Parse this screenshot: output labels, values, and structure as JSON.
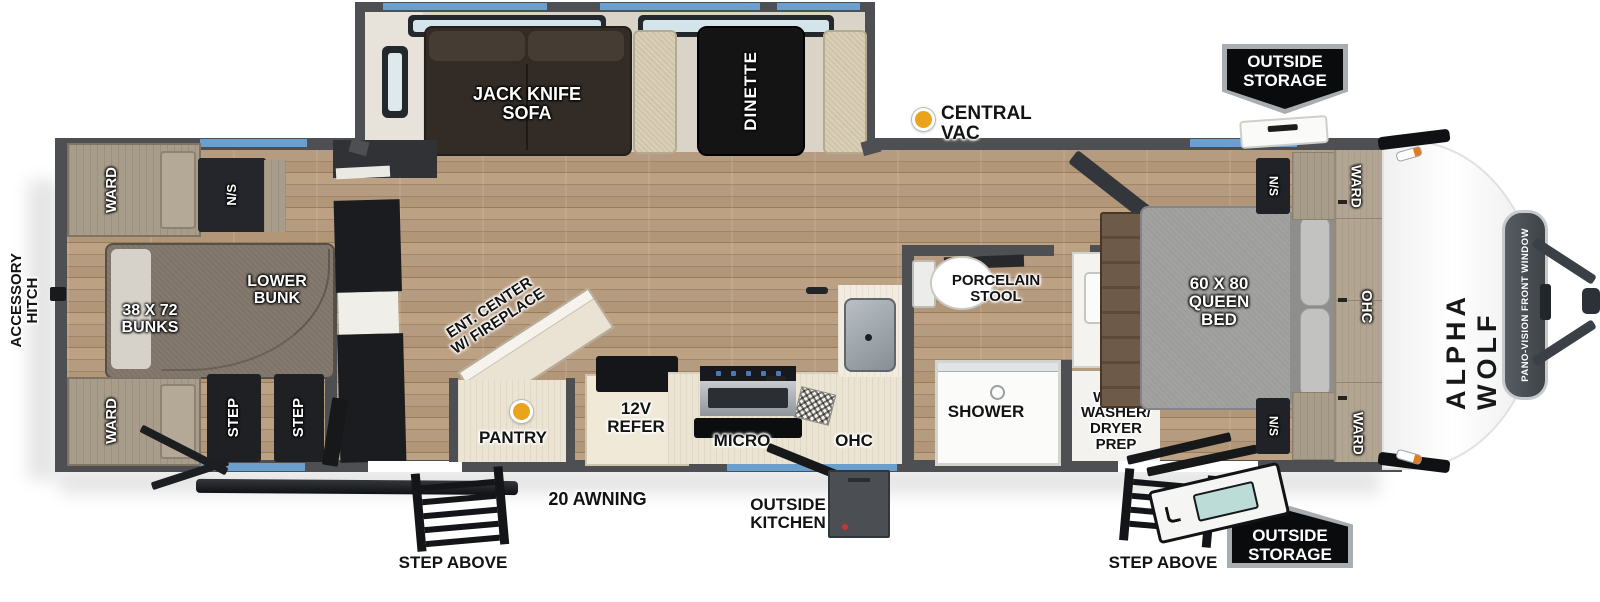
{
  "plan": {
    "brand": "ALPHA WOLF",
    "front_window": "PANO-VISION FRONT WINDOW",
    "exterior": {
      "accessory_hitch": "ACCESSORY\nHITCH",
      "central_vac": "CENTRAL VAC",
      "outside_storage_top": "OUTSIDE\nSTORAGE",
      "outside_storage_bottom": "OUTSIDE\nSTORAGE",
      "awning": "20 AWNING",
      "outside_kitchen": "OUTSIDE\nKITCHEN",
      "step_above_left": "STEP ABOVE",
      "step_above_right": "STEP ABOVE"
    },
    "slideout": {
      "sofa": "JACK KNIFE\nSOFA",
      "dinette": "DINETTE"
    },
    "bunk_room": {
      "ward_top": "WARD",
      "nightstand": "N/S",
      "bunks": "38 X 72\nBUNKS",
      "lower_bunk": "LOWER\nBUNK",
      "ward_bottom": "WARD",
      "step_1": "STEP",
      "step_2": "STEP"
    },
    "living": {
      "ent_center": "ENT. CENTER\nW/ FIREPLACE",
      "pantry": "PANTRY",
      "refer": "12V\nREFER",
      "micro": "MICRO",
      "ohc": "OHC"
    },
    "bath": {
      "stool": "PORCELAIN\nSTOOL",
      "shower": "SHOWER",
      "ward_washer": "WARD\nWASHER/\nDRYER\nPREP"
    },
    "bedroom": {
      "bed": "60 X 80\nQUEEN\nBED",
      "ohc": "OHC",
      "ward_top": "WARD",
      "ward_bottom": "WARD",
      "ns_top": "N/S",
      "ns_bottom": "N/S"
    },
    "colors": {
      "accent_blue": "#6b9fce",
      "wall_gray": "#4d4f52",
      "floor_wood": "#ae9277",
      "vac_dot_yellow": "#eaa41c",
      "badge_black": "#0a0b0d"
    }
  }
}
